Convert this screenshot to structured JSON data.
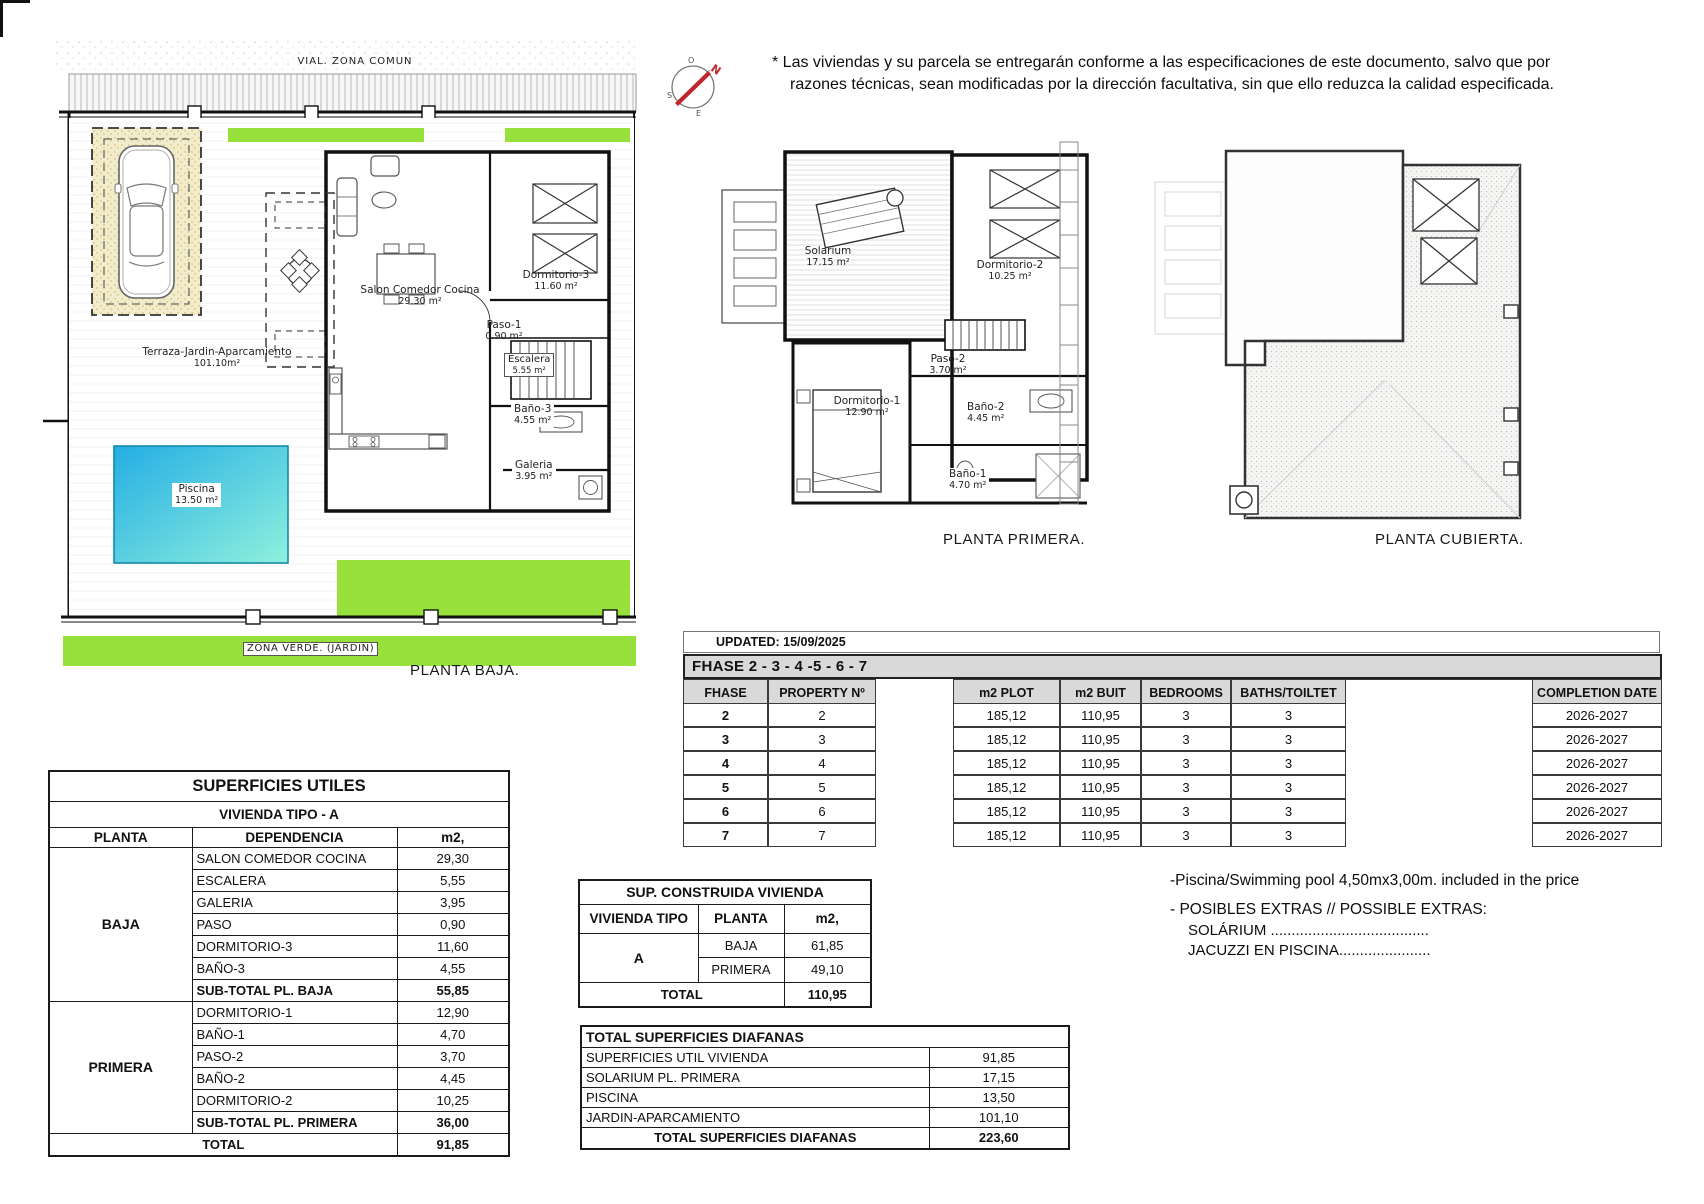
{
  "disclaimer": {
    "line1": "* Las viviendas y su parcela se entregarán conforme a las especificaciones de este documento, salvo que por",
    "line2": "razones técnicas, sean modificadas por la dirección facultativa, sin que ello reduzca la calidad especificada."
  },
  "compass": {
    "n": "N",
    "o": "O",
    "s": "S",
    "e": "E"
  },
  "plan_baja": {
    "title": "PLANTA BAJA.",
    "vial_label": "VIAL. ZONA COMUN",
    "zona_verde_label": "ZONA VERDE. (JARDIN)",
    "terraza": {
      "label": "Terraza-Jardin-Aparcamiento",
      "area": "101.10m²"
    },
    "piscina": {
      "label": "Piscina",
      "area": "13.50 m²"
    },
    "salon": {
      "label": "Salon  Comedor  Cocina",
      "area": "29.30 m²"
    },
    "dormitorio3": {
      "label": "Dormitorio-3",
      "area": "11.60 m²"
    },
    "paso1": {
      "label": "Paso-1",
      "area": "0.90 m²"
    },
    "escalera": {
      "label": "Escalera",
      "area": "5.55 m²"
    },
    "bano3": {
      "label": "Baño-3",
      "area": "4.55 m²"
    },
    "galeria": {
      "label": "Galeria",
      "area": "3.95 m²"
    }
  },
  "plan_primera": {
    "title": "PLANTA PRIMERA.",
    "solarium": {
      "label": "Solarium",
      "area": "17.15 m²"
    },
    "dormitorio2": {
      "label": "Dormitorio-2",
      "area": "10.25 m²"
    },
    "paso2": {
      "label": "Paso-2",
      "area": "3.70 m²"
    },
    "dormitorio1": {
      "label": "Dormitorio-1",
      "area": "12.90 m²"
    },
    "bano2": {
      "label": "Baño-2",
      "area": "4.45 m²"
    },
    "bano1": {
      "label": "Baño-1",
      "area": "4.70 m²"
    }
  },
  "plan_cubierta": {
    "title": "PLANTA CUBIERTA."
  },
  "phase_table": {
    "updated": "UPDATED: 15/09/2025",
    "band": "FHASE  2 - 3 - 4 -5 - 6 - 7",
    "cols": {
      "fhase": "FHASE",
      "property": "PROPERTY Nº",
      "plot": "m2 PLOT",
      "built": "m2 BUIT",
      "bedrooms": "BEDROOMS",
      "baths": "BATHS/TOILTET",
      "completion": "COMPLETION DATE"
    },
    "rows": [
      {
        "f": "2",
        "p": "2",
        "plot": "185,12",
        "built": "110,95",
        "bed": "3",
        "bath": "3",
        "date": "2026-2027"
      },
      {
        "f": "3",
        "p": "3",
        "plot": "185,12",
        "built": "110,95",
        "bed": "3",
        "bath": "3",
        "date": "2026-2027"
      },
      {
        "f": "4",
        "p": "4",
        "plot": "185,12",
        "built": "110,95",
        "bed": "3",
        "bath": "3",
        "date": "2026-2027"
      },
      {
        "f": "5",
        "p": "5",
        "plot": "185,12",
        "built": "110,95",
        "bed": "3",
        "bath": "3",
        "date": "2026-2027"
      },
      {
        "f": "6",
        "p": "6",
        "plot": "185,12",
        "built": "110,95",
        "bed": "3",
        "bath": "3",
        "date": "2026-2027"
      },
      {
        "f": "7",
        "p": "7",
        "plot": "185,12",
        "built": "110,95",
        "bed": "3",
        "bath": "3",
        "date": "2026-2027"
      }
    ]
  },
  "superficies_utiles": {
    "title": "SUPERFICIES UTILES",
    "subtitle": "VIVIENDA TIPO - A",
    "cols": {
      "planta": "PLANTA",
      "dep": "DEPENDENCIA",
      "m2": "m2,"
    },
    "baja_label": "BAJA",
    "primera_label": "PRIMERA",
    "rows_baja": [
      {
        "dep": "SALON COMEDOR COCINA",
        "m2": "29,30"
      },
      {
        "dep": "ESCALERA",
        "m2": "5,55"
      },
      {
        "dep": "GALERIA",
        "m2": "3,95"
      },
      {
        "dep": "PASO",
        "m2": "0,90"
      },
      {
        "dep": "DORMITORIO-3",
        "m2": "11,60"
      },
      {
        "dep": "BAÑO-3",
        "m2": "4,55"
      }
    ],
    "subtotal_baja": {
      "dep": "SUB-TOTAL PL. BAJA",
      "m2": "55,85"
    },
    "rows_primera": [
      {
        "dep": "DORMITORIO-1",
        "m2": "12,90"
      },
      {
        "dep": "BAÑO-1",
        "m2": "4,70"
      },
      {
        "dep": "PASO-2",
        "m2": "3,70"
      },
      {
        "dep": "BAÑO-2",
        "m2": "4,45"
      },
      {
        "dep": "DORMITORIO-2",
        "m2": "10,25"
      }
    ],
    "subtotal_primera": {
      "dep": "SUB-TOTAL PL. PRIMERA",
      "m2": "36,00"
    },
    "total": {
      "label": "TOTAL",
      "m2": "91,85"
    }
  },
  "sup_construida": {
    "title": "SUP. CONSTRUIDA VIVIENDA",
    "cols": {
      "tipo": "VIVIENDA TIPO",
      "planta": "PLANTA",
      "m2": "m2,"
    },
    "tipo": "A",
    "rows": [
      {
        "planta": "BAJA",
        "m2": "61,85"
      },
      {
        "planta": "PRIMERA",
        "m2": "49,10"
      }
    ],
    "total": {
      "label": "TOTAL",
      "m2": "110,95"
    }
  },
  "diafanas": {
    "title": "TOTAL SUPERFICIES DIAFANAS",
    "rows": [
      {
        "label": "SUPERFICIES UTIL VIVIENDA",
        "m2": "91,85"
      },
      {
        "label": "SOLARIUM PL. PRIMERA",
        "m2": "17,15"
      },
      {
        "label": "PISCINA",
        "m2": "13,50"
      },
      {
        "label": "JARDIN-APARCAMIENTO",
        "m2": "101,10"
      }
    ],
    "total": {
      "label": "TOTAL SUPERFICIES DIAFANAS",
      "m2": "223,60"
    }
  },
  "notes": {
    "pool": "-Piscina/Swimming pool 4,50mx3,00m. included in the price",
    "extras_title": "- POSIBLES EXTRAS // POSSIBLE EXTRAS:",
    "extra1": "SOLÁRIUM ......................................",
    "extra2": "JACUZZI EN PISCINA......................"
  },
  "colors": {
    "green": "#98e03c",
    "pool_start": "#24aee4",
    "pool_end": "#8ff0dd",
    "sand": "#f2ecca",
    "table_gray": "#d9d9d9"
  }
}
